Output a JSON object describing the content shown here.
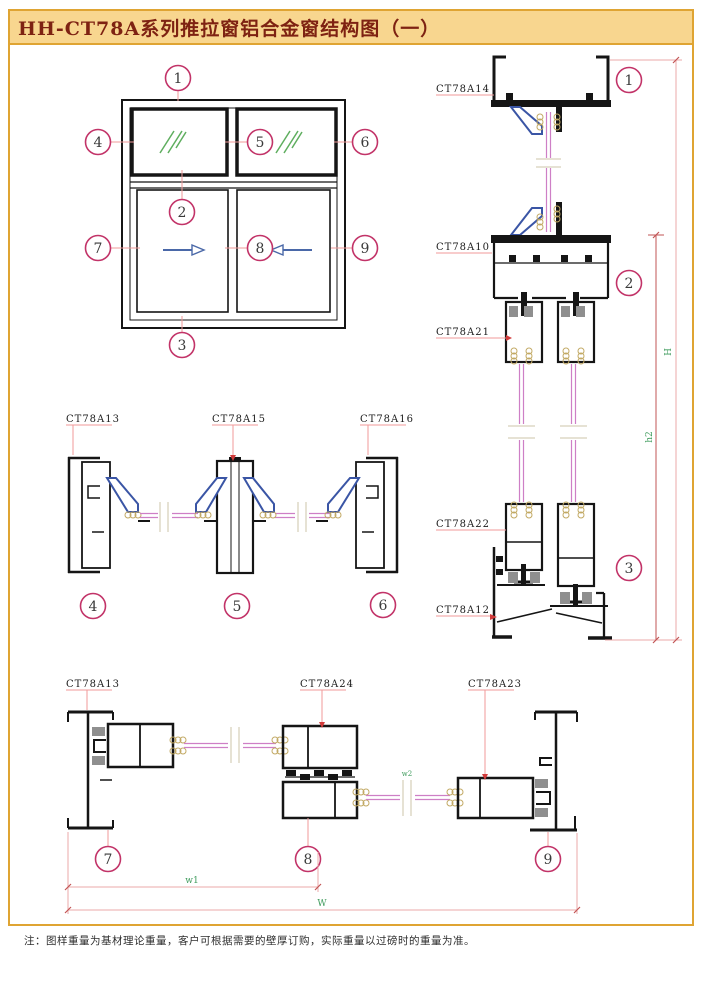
{
  "title": "HH-CT78A系列推拉窗铝合金窗结构图（一）",
  "note": "注：图样重量为基材理论重量，客户可根据需要的壁厚订购，实际重量以过磅时的重量为准。",
  "elevation": {
    "callouts": {
      "c1": "1",
      "c2": "2",
      "c3": "3",
      "c4": "4",
      "c5": "5",
      "c6": "6",
      "c7": "7",
      "c8": "8",
      "c9": "9"
    }
  },
  "vertical_section": {
    "labels": {
      "head": "CT78A14",
      "transom": "CT78A10",
      "sash_top": "CT78A21",
      "sash_bottom": "CT78A22",
      "sill": "CT78A12"
    },
    "callouts": {
      "c1": "1",
      "c2": "2",
      "c3": "3"
    },
    "dims": {
      "overall": "H",
      "lower": "h2"
    }
  },
  "top_horizontal_section": {
    "labels": {
      "left_jamb": "CT78A13",
      "mullion": "CT78A15",
      "right_jamb": "CT78A16"
    },
    "callouts": {
      "c4": "4",
      "c5": "5",
      "c6": "6"
    }
  },
  "bottom_horizontal_section": {
    "labels": {
      "left_jamb": "CT78A13",
      "interlock": "CT78A24",
      "right_sash": "CT78A23"
    },
    "callouts": {
      "c7": "7",
      "c8": "8",
      "c9": "9"
    },
    "dims": {
      "sash_width": "w1",
      "overall_width": "W",
      "glass": "w2"
    }
  },
  "colors": {
    "border_gold": "#DFA433",
    "title_bg": "#F8D68F",
    "title_text": "#7E2212",
    "callout": "#C23368",
    "glass_pink": "#CE7FC6",
    "bead_blue": "#3A55A5",
    "sealant_tan": "#C2A964",
    "dim_green": "#3E9B5C",
    "leader_pink": "#F09A9A",
    "dim_line": "#EBA8A8",
    "dim_line_inner": "#C25555",
    "arrow_red": "#D23B3B",
    "pile_gray": "#8F8F8F"
  }
}
